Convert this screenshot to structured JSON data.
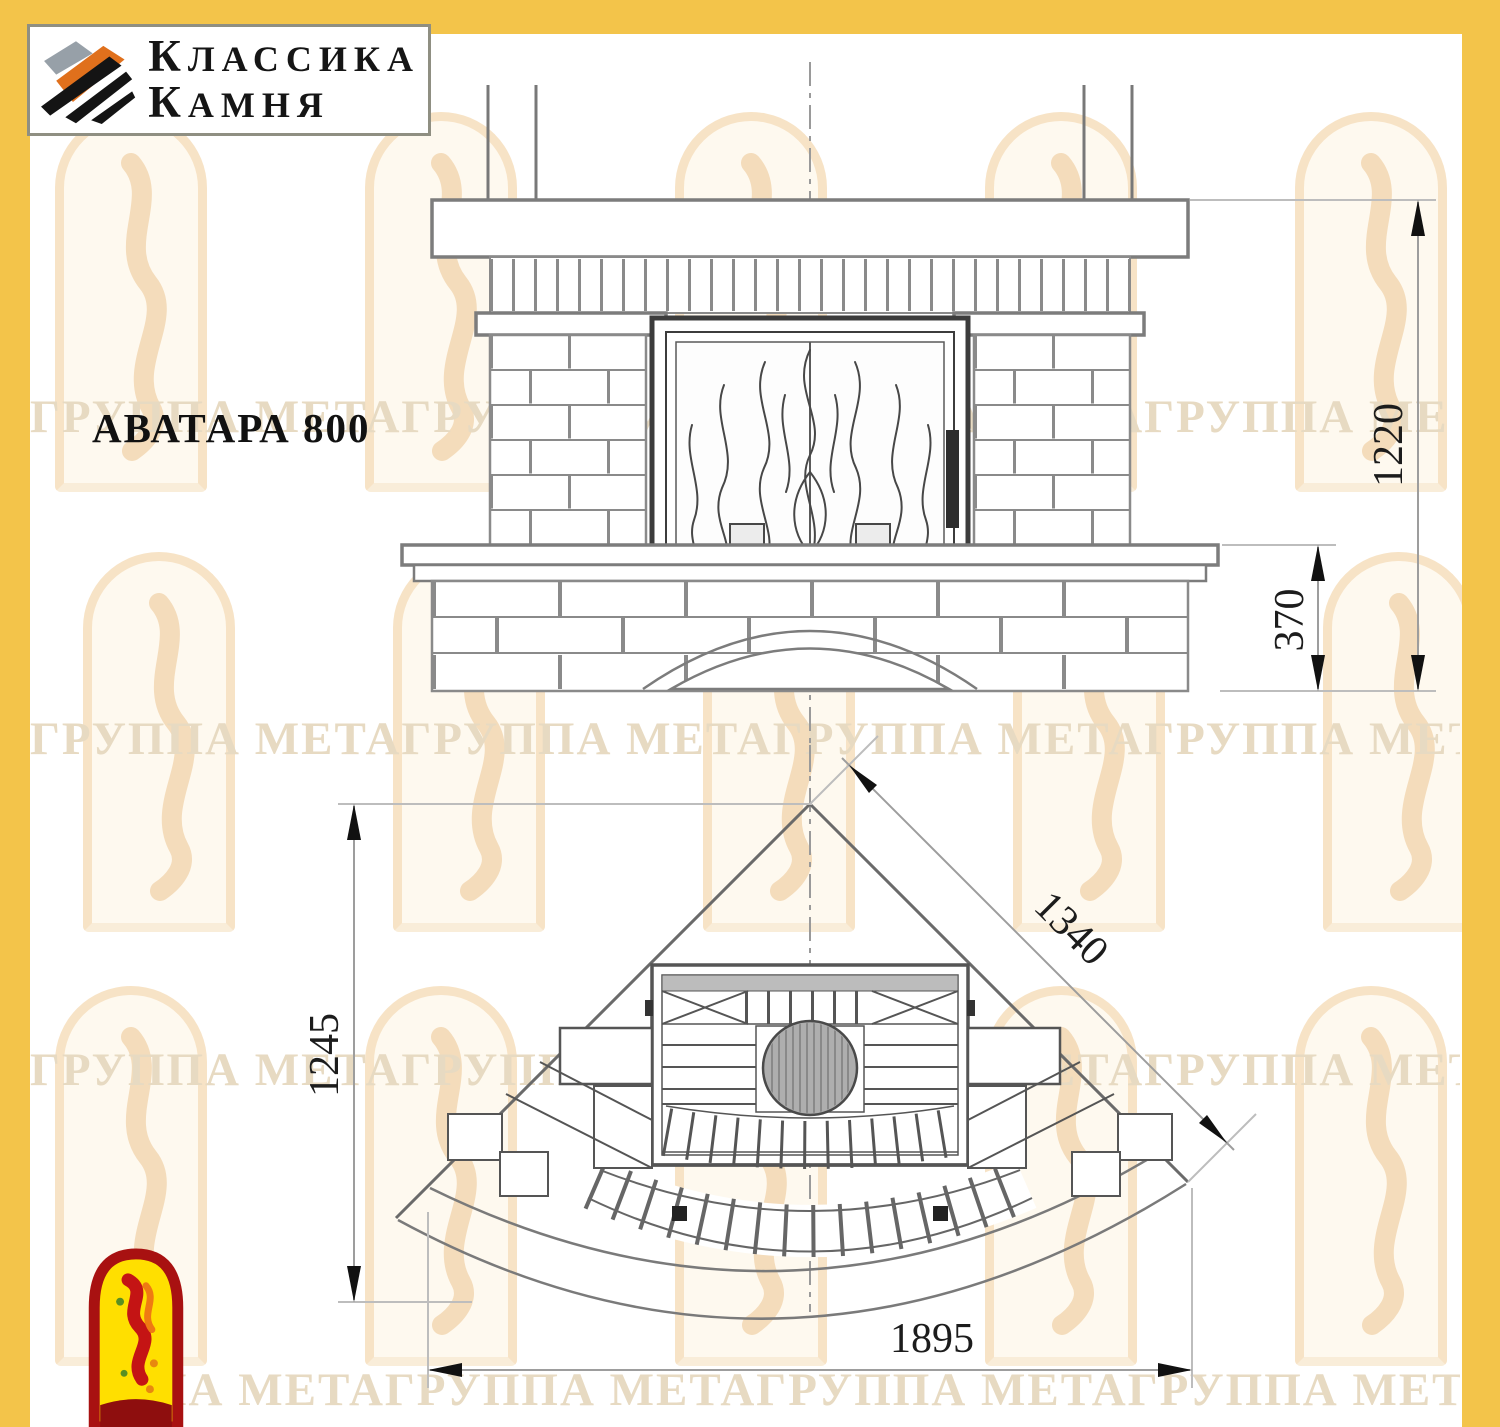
{
  "brand": {
    "line1": "КЛАССИКА",
    "line2": "КАМНЯ"
  },
  "title": "АВАТАРА 800",
  "front_view": {
    "label_total_height": "1220",
    "label_bench_height": "370"
  },
  "plan_view": {
    "label_depth": "1245",
    "label_side": "1340",
    "label_width": "1895"
  },
  "watermark": {
    "rows": [
      "ГРУППА МЕТАГРУППА МЕТАГРУППА МЕТАГРУППА МЕ",
      "ГРУППА МЕТАГРУППА МЕТАГРУППА МЕТАГРУППА МЕТ",
      "ГРУППА МЕТАГРУППА МЕТАГРУППА МЕТАГРУППА МЕТА",
      "ПА МЕТАГРУППА МЕТАГРУППА МЕТАГРУППА МЕТАГРУ"
    ]
  },
  "colors": {
    "frame_yellow": "#F3C44A",
    "logo_grey": "#97A0A8",
    "logo_orange": "#E0701C",
    "logo_black": "#141414",
    "mascot_red": "#A81111",
    "mascot_yellow": "#FFDF00",
    "watermark_text": "#E7DAC2",
    "drawing_line": "#6E6E6E"
  }
}
